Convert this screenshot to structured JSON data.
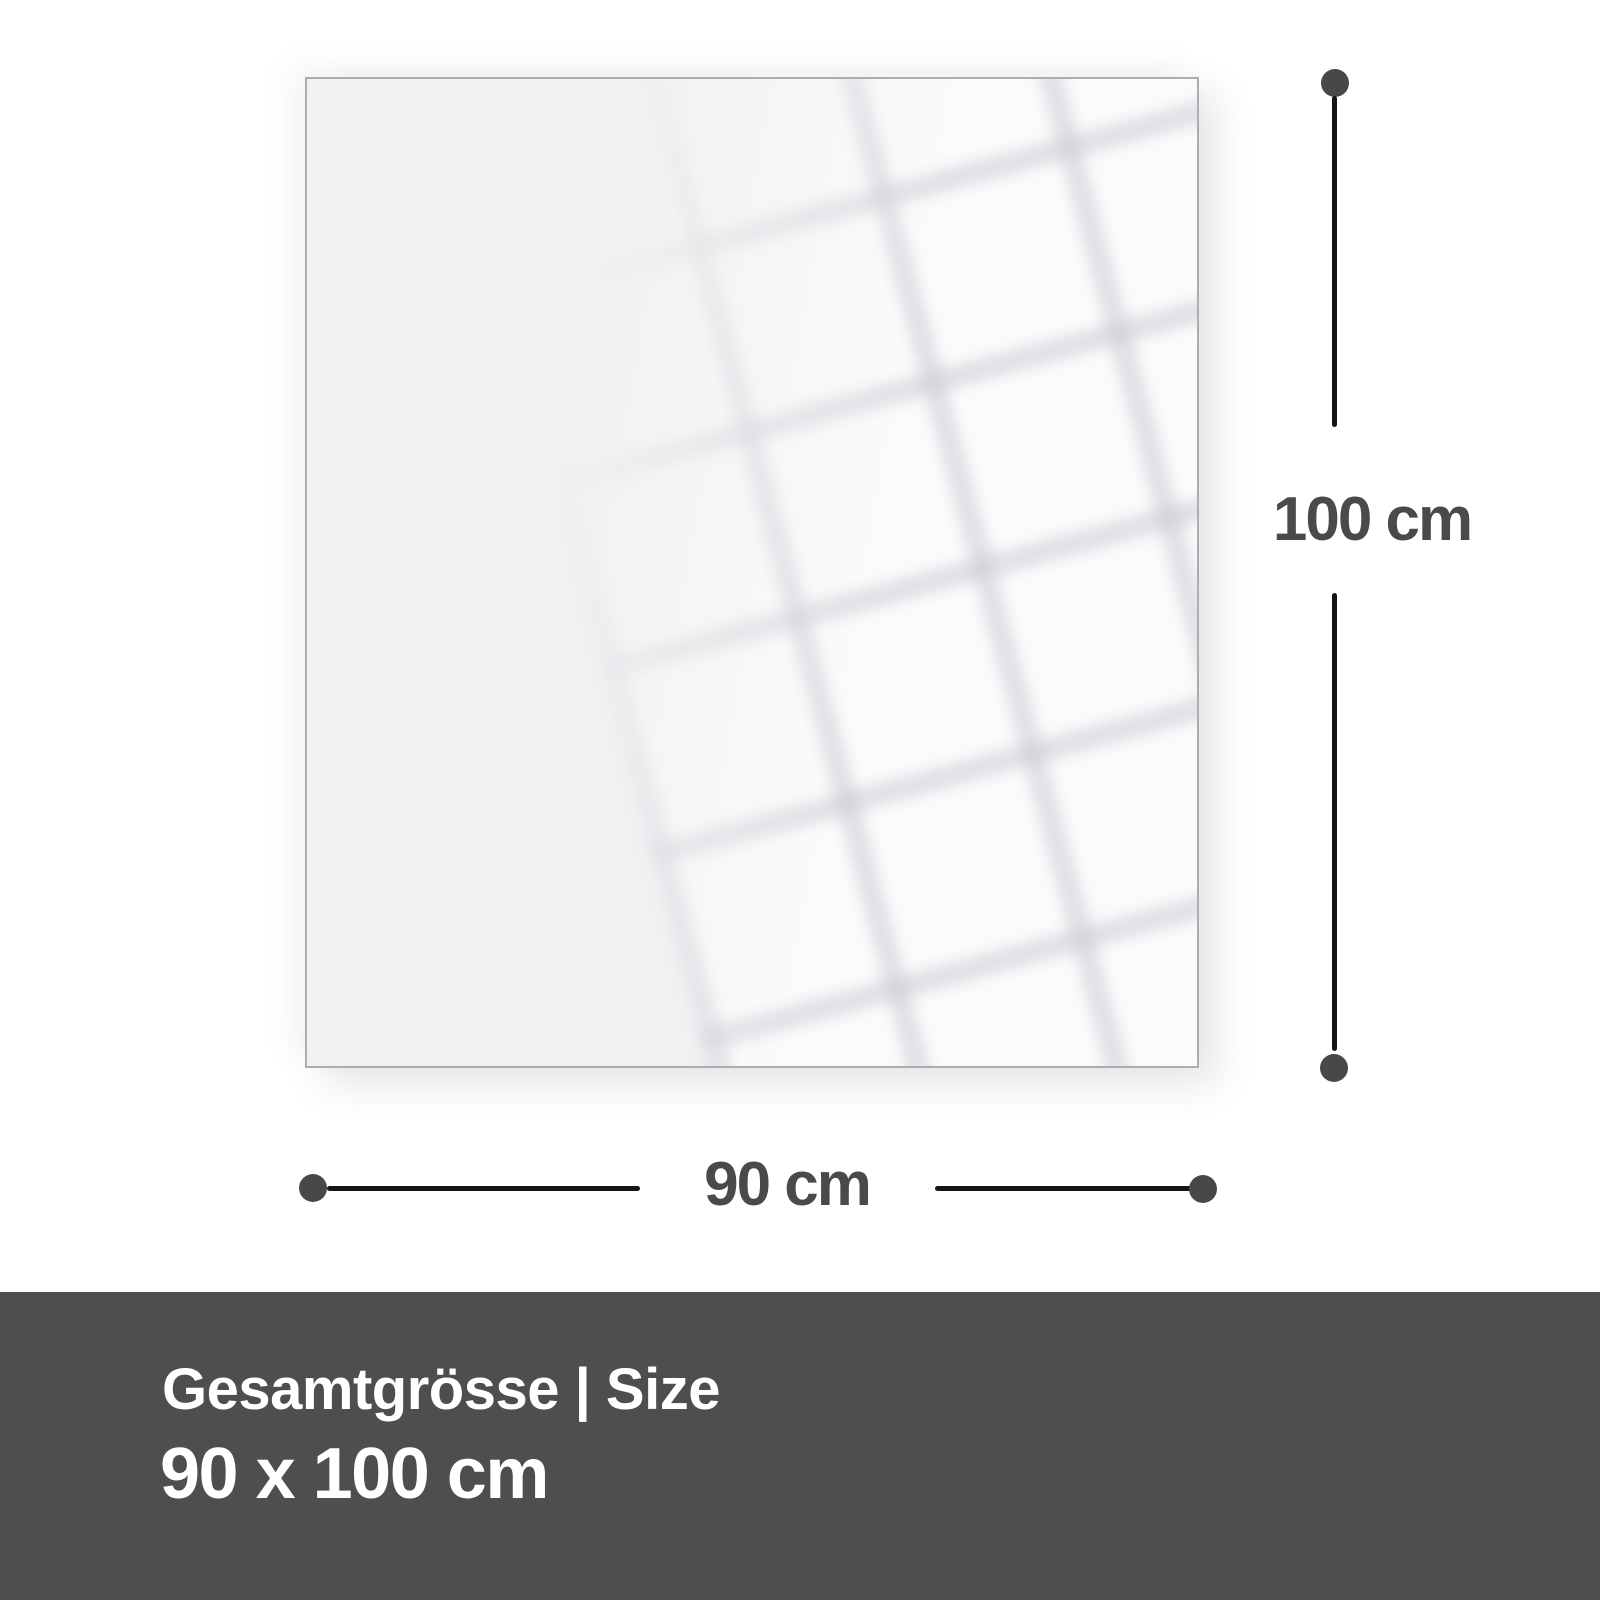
{
  "dimensions": {
    "vertical": {
      "label": "100 cm"
    },
    "horizontal": {
      "label": "90 cm"
    }
  },
  "footer": {
    "title": "Gesamtgrösse | Size",
    "size": "90 x 100 cm"
  },
  "colors": {
    "page_background": "#ffffff",
    "panel_fill": "#f1f1f3",
    "panel_border": "#adadb0",
    "dimension_line": "#151515",
    "dimension_dot": "#48484a",
    "dimension_label": "#4a4a4c",
    "footer_background": "#4e4e50",
    "footer_text": "#ffffff"
  }
}
